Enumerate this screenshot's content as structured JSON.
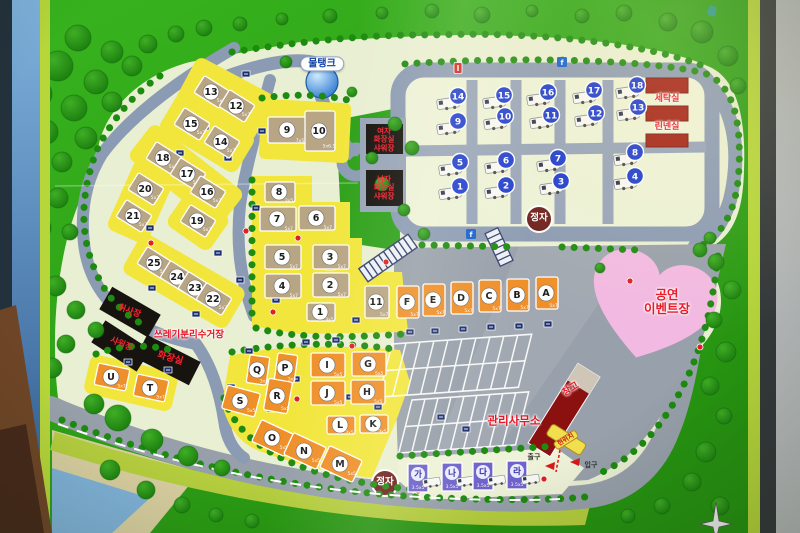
{
  "labels": {
    "water_tank": "물탱크",
    "women_restroom": "여자\n화장실\n샤워장",
    "men_restroom": "남자\n화장실\n샤워장",
    "laundry": "세탁실",
    "linen_room": "린넨실",
    "cookhouse": "취사장",
    "shower": "샤워장",
    "toilet": "화장실",
    "recycling": "쓰레기분리수거장",
    "event_area": "공연\n이벤트장",
    "office": "관리사무소",
    "warehouse": "창고",
    "current_location": "현위치",
    "exit": "출구",
    "entrance": "입구",
    "pavilion_upper": "정자",
    "pavilion_lower": "정자"
  },
  "colors": {
    "map_green": "#2ea11a",
    "panel": "#e9efd3",
    "road": "#8c9bb4",
    "apron": "#98a0ab",
    "site_yellow": "#f2e63c",
    "pad_tan": "#b8a584",
    "pad_orange": "#ef8f2a",
    "pad_purple": "#6f63cc",
    "caravan_blue": "#1d3bd0",
    "label_red": "#e81626",
    "heart_pink": "#f2b9e2",
    "building_black": "#17130f",
    "building_red": "#a32016"
  },
  "sites": {
    "tent_left": [
      {
        "label": "13",
        "x": 212,
        "y": 92,
        "dim": "5x7"
      },
      {
        "label": "12",
        "x": 237,
        "y": 106,
        "dim": "5x7"
      },
      {
        "label": "15",
        "x": 192,
        "y": 124,
        "dim": "5x7"
      },
      {
        "label": "14",
        "x": 222,
        "y": 142,
        "dim": "5x7"
      },
      {
        "label": "18",
        "x": 164,
        "y": 158,
        "dim": "5x7"
      },
      {
        "label": "17",
        "x": 188,
        "y": 174,
        "dim": "5x7"
      },
      {
        "label": "16",
        "x": 208,
        "y": 192,
        "dim": "5x7"
      },
      {
        "label": "20",
        "x": 146,
        "y": 189,
        "dim": "5x7"
      },
      {
        "label": "21",
        "x": 134,
        "y": 216,
        "dim": "5x7"
      },
      {
        "label": "19",
        "x": 198,
        "y": 221,
        "dim": "5x7"
      },
      {
        "label": "25",
        "x": 155,
        "y": 263,
        "dim": "5x7"
      },
      {
        "label": "24",
        "x": 178,
        "y": 277,
        "dim": "5x7"
      },
      {
        "label": "23",
        "x": 196,
        "y": 288,
        "dim": "5x7"
      },
      {
        "label": "22",
        "x": 214,
        "y": 299,
        "dim": "5x7"
      }
    ],
    "tent_center": [
      {
        "label": "9",
        "x": 288,
        "y": 130,
        "dim": "7x5",
        "w": 40,
        "h": 26
      },
      {
        "label": "10",
        "x": 320,
        "y": 131,
        "dim": "5x6.5",
        "w": 30,
        "h": 40
      },
      {
        "label": "8",
        "x": 280,
        "y": 192,
        "dim": "3x5",
        "w": 30,
        "h": 20
      },
      {
        "label": "7",
        "x": 278,
        "y": 219,
        "dim": "5x7"
      },
      {
        "label": "6",
        "x": 317,
        "y": 218,
        "dim": "5x7"
      },
      {
        "label": "5",
        "x": 283,
        "y": 257,
        "dim": "5x7"
      },
      {
        "label": "3",
        "x": 331,
        "y": 257,
        "dim": "5x7"
      },
      {
        "label": "4",
        "x": 283,
        "y": 286,
        "dim": "5x7"
      },
      {
        "label": "2",
        "x": 331,
        "y": 285,
        "dim": "5x7"
      },
      {
        "label": "1",
        "x": 321,
        "y": 312,
        "dim": "3x5",
        "w": 28,
        "h": 18
      },
      {
        "label": "11",
        "x": 377,
        "y": 302,
        "dim": "5x7",
        "w": 24,
        "h": 32
      }
    ],
    "letter_row": [
      {
        "label": "F",
        "x": 408,
        "y": 302,
        "dim": "5x7"
      },
      {
        "label": "E",
        "x": 434,
        "y": 300,
        "dim": "5x7"
      },
      {
        "label": "D",
        "x": 462,
        "y": 298,
        "dim": "5x7"
      },
      {
        "label": "C",
        "x": 490,
        "y": 296,
        "dim": "5x7"
      },
      {
        "label": "B",
        "x": 518,
        "y": 295,
        "dim": "5x7"
      },
      {
        "label": "A",
        "x": 547,
        "y": 293,
        "dim": "5x7"
      }
    ],
    "letter_lower": [
      {
        "label": "Q",
        "x": 258,
        "y": 370,
        "dim": "3x5",
        "w": 20,
        "h": 28,
        "rot": 8
      },
      {
        "label": "P",
        "x": 286,
        "y": 368,
        "dim": "3x5",
        "w": 20,
        "h": 28,
        "rot": 8
      },
      {
        "label": "I",
        "x": 328,
        "y": 365,
        "dim": "5x5",
        "w": 34,
        "h": 24,
        "rot": 0
      },
      {
        "label": "G",
        "x": 369,
        "y": 364,
        "dim": "5x5",
        "w": 34,
        "h": 24,
        "rot": 0
      },
      {
        "label": "S",
        "x": 241,
        "y": 401,
        "dim": "5x5",
        "w": 34,
        "h": 24,
        "rot": 15
      },
      {
        "label": "R",
        "x": 278,
        "y": 396,
        "dim": "5x5",
        "w": 24,
        "h": 32,
        "rot": 10
      },
      {
        "label": "J",
        "x": 328,
        "y": 393,
        "dim": "5x5",
        "w": 34,
        "h": 24,
        "rot": 0
      },
      {
        "label": "H",
        "x": 368,
        "y": 392,
        "dim": "5x5",
        "w": 34,
        "h": 24,
        "rot": 0
      },
      {
        "label": "L",
        "x": 341,
        "y": 425,
        "dim": "3x5",
        "w": 28,
        "h": 18,
        "rot": 0
      },
      {
        "label": "K",
        "x": 374,
        "y": 424,
        "dim": "3x5",
        "w": 28,
        "h": 18,
        "rot": 0
      },
      {
        "label": "O",
        "x": 273,
        "y": 438,
        "dim": "5x5",
        "w": 36,
        "h": 24,
        "rot": 25
      },
      {
        "label": "N",
        "x": 305,
        "y": 451,
        "dim": "5x5",
        "w": 36,
        "h": 24,
        "rot": 25
      },
      {
        "label": "M",
        "x": 341,
        "y": 464,
        "dim": "5x5",
        "w": 36,
        "h": 24,
        "rot": 25
      },
      {
        "label": "U",
        "x": 112,
        "y": 377,
        "dim": "5x7",
        "w": 32,
        "h": 22,
        "rot": 12
      },
      {
        "label": "T",
        "x": 151,
        "y": 388,
        "dim": "5x7",
        "w": 32,
        "h": 22,
        "rot": 12
      }
    ],
    "caravan": [
      {
        "label": "1",
        "x": 452,
        "y": 193
      },
      {
        "label": "2",
        "x": 498,
        "y": 192
      },
      {
        "label": "3",
        "x": 553,
        "y": 188
      },
      {
        "label": "4",
        "x": 627,
        "y": 183
      },
      {
        "label": "5",
        "x": 452,
        "y": 169
      },
      {
        "label": "6",
        "x": 498,
        "y": 167
      },
      {
        "label": "7",
        "x": 550,
        "y": 165
      },
      {
        "label": "8",
        "x": 627,
        "y": 159
      },
      {
        "label": "9",
        "x": 450,
        "y": 128
      },
      {
        "label": "10",
        "x": 497,
        "y": 123
      },
      {
        "label": "11",
        "x": 543,
        "y": 122
      },
      {
        "label": "12",
        "x": 588,
        "y": 120
      },
      {
        "label": "13",
        "x": 630,
        "y": 114
      },
      {
        "label": "14",
        "x": 450,
        "y": 103
      },
      {
        "label": "15",
        "x": 496,
        "y": 102
      },
      {
        "label": "16",
        "x": 540,
        "y": 99
      },
      {
        "label": "17",
        "x": 586,
        "y": 97
      },
      {
        "label": "18",
        "x": 629,
        "y": 92
      }
    ],
    "family": [
      {
        "label": "가",
        "x": 418,
        "y": 478,
        "dim": "3.5x5"
      },
      {
        "label": "나",
        "x": 452,
        "y": 477,
        "dim": "3.5x5"
      },
      {
        "label": "다",
        "x": 483,
        "y": 476,
        "dim": "3.5x5"
      },
      {
        "label": "라",
        "x": 517,
        "y": 475,
        "dim": "3.5x5"
      }
    ]
  },
  "markers": {
    "power": [
      [
        246,
        74
      ],
      [
        205,
        127
      ],
      [
        262,
        131
      ],
      [
        180,
        153
      ],
      [
        228,
        158
      ],
      [
        196,
        184
      ],
      [
        256,
        208
      ],
      [
        150,
        228
      ],
      [
        218,
        253
      ],
      [
        240,
        280
      ],
      [
        152,
        288
      ],
      [
        196,
        314
      ],
      [
        264,
        228
      ],
      [
        330,
        267
      ],
      [
        276,
        300
      ],
      [
        318,
        311
      ],
      [
        356,
        320
      ],
      [
        410,
        332
      ],
      [
        435,
        331
      ],
      [
        463,
        329
      ],
      [
        491,
        327
      ],
      [
        519,
        326
      ],
      [
        548,
        324
      ],
      [
        249,
        351
      ],
      [
        231,
        387
      ],
      [
        296,
        379
      ],
      [
        271,
        409
      ],
      [
        350,
        397
      ],
      [
        378,
        407
      ],
      [
        441,
        417
      ],
      [
        466,
        429
      ],
      [
        128,
        362
      ],
      [
        168,
        370
      ],
      [
        306,
        342
      ],
      [
        336,
        340
      ]
    ],
    "hydrant": [
      [
        223,
        148
      ],
      [
        246,
        231
      ],
      [
        298,
        238
      ],
      [
        273,
        312
      ],
      [
        386,
        262
      ],
      [
        352,
        346
      ],
      [
        297,
        399
      ],
      [
        227,
        399
      ],
      [
        514,
        296
      ],
      [
        630,
        281
      ],
      [
        700,
        347
      ],
      [
        544,
        479
      ],
      [
        418,
        491
      ],
      [
        151,
        243
      ]
    ],
    "water_point": [
      [
        562,
        62
      ],
      [
        471,
        234
      ]
    ],
    "sign_post": [
      [
        458,
        68
      ]
    ]
  }
}
